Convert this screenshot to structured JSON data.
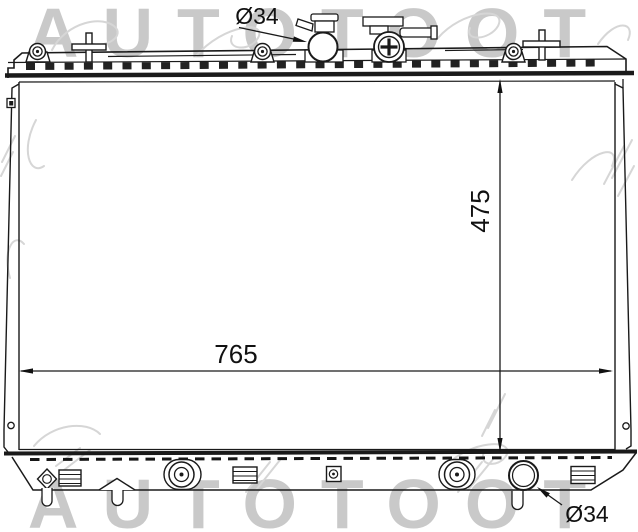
{
  "drawing": {
    "subject_label": "radiator-outline-drawing"
  },
  "watermark": {
    "text": "AUTOTOOT",
    "color": "#c9c9c9"
  },
  "dimensions": {
    "inlet_diameter": "Ø34",
    "core_height": "475",
    "core_width": "765",
    "outlet_diameter": "Ø34"
  },
  "colors": {
    "line": "#1a1a1a",
    "background": "#ffffff",
    "dimension_text": "#111111",
    "watermark": "#c9c9c9"
  }
}
